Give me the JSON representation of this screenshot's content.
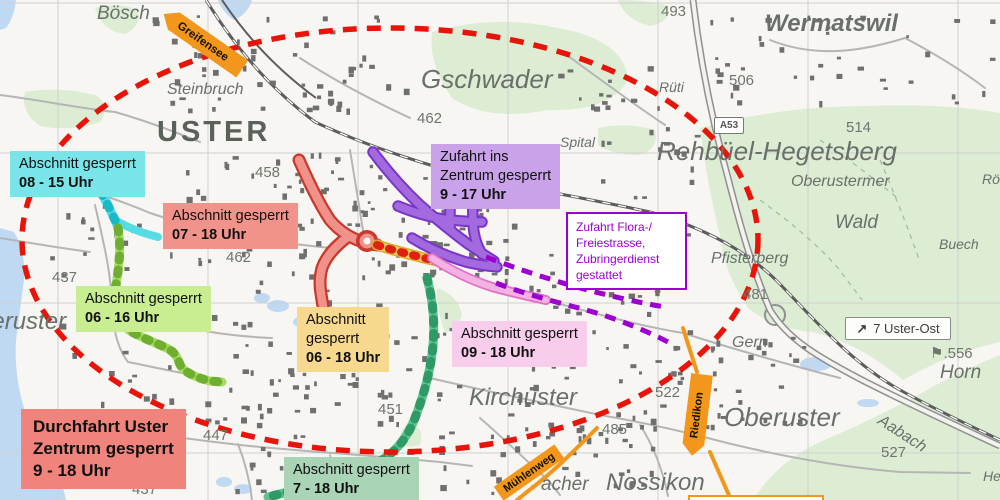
{
  "closures": {
    "c1": {
      "line1": "Abschnitt gesperrt",
      "line2": "08 - 15 Uhr",
      "bg": "#79e5e9"
    },
    "c2": {
      "line1": "Abschnitt gesperrt",
      "line2": "07 - 18 Uhr",
      "bg": "#f2938b"
    },
    "c3": {
      "line1": "Abschnitt gesperrt",
      "line2": "06 - 16 Uhr",
      "bg": "#c9ee92"
    },
    "c4": {
      "line1": "Abschnitt",
      "line2": "gesperrt",
      "line3": "06 - 18 Uhr",
      "bg": "#f6d98e"
    },
    "c5": {
      "line1": "Zufahrt ins",
      "line2": "Zentrum gesperrt",
      "line3": "9 - 17 Uhr",
      "bg": "#c9a2ea"
    },
    "c6": {
      "line1": "Abschnitt gesperrt",
      "line2": "09 - 18 Uhr",
      "bg": "#f8cdec"
    },
    "c7": {
      "line1": "Abschnitt gesperrt",
      "line2": "7 - 18 Uhr",
      "bg": "#a9d5b6"
    },
    "c8": {
      "line1": "Durchfahrt Uster",
      "line2": "Zentrum gesperrt",
      "line3": "9 - 18 Uhr",
      "bg": "#f0837c"
    }
  },
  "permission_box": {
    "line1": "Zufahrt Flora-/",
    "line2": "Freiestrasse,",
    "line3": "Zubringerdienst",
    "line4": "gestattet",
    "color": "#9b00d0"
  },
  "signs": {
    "greifensee": "Greifensee",
    "riedikon": "Riedikon",
    "muehlenweg": "Mühlenweg",
    "uster_ost_arrow": "↗",
    "uster_ost": "7 Uster-Ost",
    "a53": "A53"
  },
  "places": [
    {
      "t": "Bösch",
      "x": 97,
      "y": 3,
      "c": "lg"
    },
    {
      "t": "Steinbruch",
      "x": 167,
      "y": 81,
      "c": "md"
    },
    {
      "t": "USTER",
      "x": 157,
      "y": 116,
      "c": "city"
    },
    {
      "t": "Gschwader",
      "x": 421,
      "y": 64,
      "c": "xxl"
    },
    {
      "t": "462",
      "x": 417,
      "y": 110,
      "c": "num"
    },
    {
      "t": "Wermatswil",
      "x": 765,
      "y": 10,
      "c": "xl",
      "w": 600
    },
    {
      "t": "493",
      "x": 661,
      "y": 3,
      "c": "num"
    },
    {
      "t": "Rüti",
      "x": 659,
      "y": 79,
      "c": "sm"
    },
    {
      "t": "506",
      "x": 729,
      "y": 72,
      "c": "num"
    },
    {
      "t": "514",
      "x": 846,
      "y": 119,
      "c": "num"
    },
    {
      "t": "Rehbüel-Hegetsberg",
      "x": 657,
      "y": 136,
      "c": "xxl"
    },
    {
      "t": "Oberustermer",
      "x": 791,
      "y": 173,
      "c": "md"
    },
    {
      "t": "Wald",
      "x": 835,
      "y": 212,
      "c": "lg"
    },
    {
      "t": "Buech",
      "x": 939,
      "y": 236,
      "c": "sm"
    },
    {
      "t": "Rö",
      "x": 982,
      "y": 171,
      "c": "sm"
    },
    {
      "t": "Pfisterberg",
      "x": 711,
      "y": 250,
      "c": "md"
    },
    {
      "t": "Spital",
      "x": 560,
      "y": 134,
      "c": "sm"
    },
    {
      "t": "458",
      "x": 255,
      "y": 164,
      "c": "num"
    },
    {
      "t": "ARA",
      "x": 76,
      "y": 186,
      "c": "caps"
    },
    {
      "t": "462",
      "x": 226,
      "y": 249,
      "c": "num"
    },
    {
      "t": "437",
      "x": 52,
      "y": 269,
      "c": "num"
    },
    {
      "t": "Niederuster",
      "x": -58,
      "y": 308,
      "c": "xl"
    },
    {
      "t": "Kirchuster",
      "x": 469,
      "y": 384,
      "c": "xl"
    },
    {
      "t": "451",
      "x": 378,
      "y": 401,
      "c": "num"
    },
    {
      "t": "447",
      "x": 203,
      "y": 427,
      "c": "num"
    },
    {
      "t": "437",
      "x": 132,
      "y": 481,
      "c": "num"
    },
    {
      "t": "522",
      "x": 655,
      "y": 384,
      "c": "num"
    },
    {
      "t": "485",
      "x": 602,
      "y": 421,
      "c": "num"
    },
    {
      "t": "481",
      "x": 743,
      "y": 286,
      "c": "num"
    },
    {
      "t": "Gern",
      "x": 732,
      "y": 334,
      "c": "md"
    },
    {
      "t": "⚑.556",
      "x": 930,
      "y": 344,
      "c": "num"
    },
    {
      "t": "Horn",
      "x": 940,
      "y": 362,
      "c": "lg"
    },
    {
      "t": "Aabach",
      "x": 884,
      "y": 412,
      "c": "md",
      "r": 33
    },
    {
      "t": "527",
      "x": 881,
      "y": 444,
      "c": "num"
    },
    {
      "t": "Oberuster",
      "x": 724,
      "y": 402,
      "c": "xxl"
    },
    {
      "t": "Nossikon",
      "x": 606,
      "y": 469,
      "c": "xl"
    },
    {
      "t": "acher",
      "x": 541,
      "y": 474,
      "c": "lg"
    },
    {
      "t": "He",
      "x": 983,
      "y": 468,
      "c": "sm"
    }
  ],
  "colors": {
    "ellipse": "#e81309",
    "purple_dash": "#9b00d0",
    "orange": "#f2961c",
    "cyan_road": "#55dce4",
    "green_road": "#a6dc66",
    "teal_road": "#5bc491",
    "red_road": "#f0928a",
    "yellow_road": "#f2d357",
    "purple_road": "#a36ae0",
    "pink_road": "#f4b2e2"
  }
}
